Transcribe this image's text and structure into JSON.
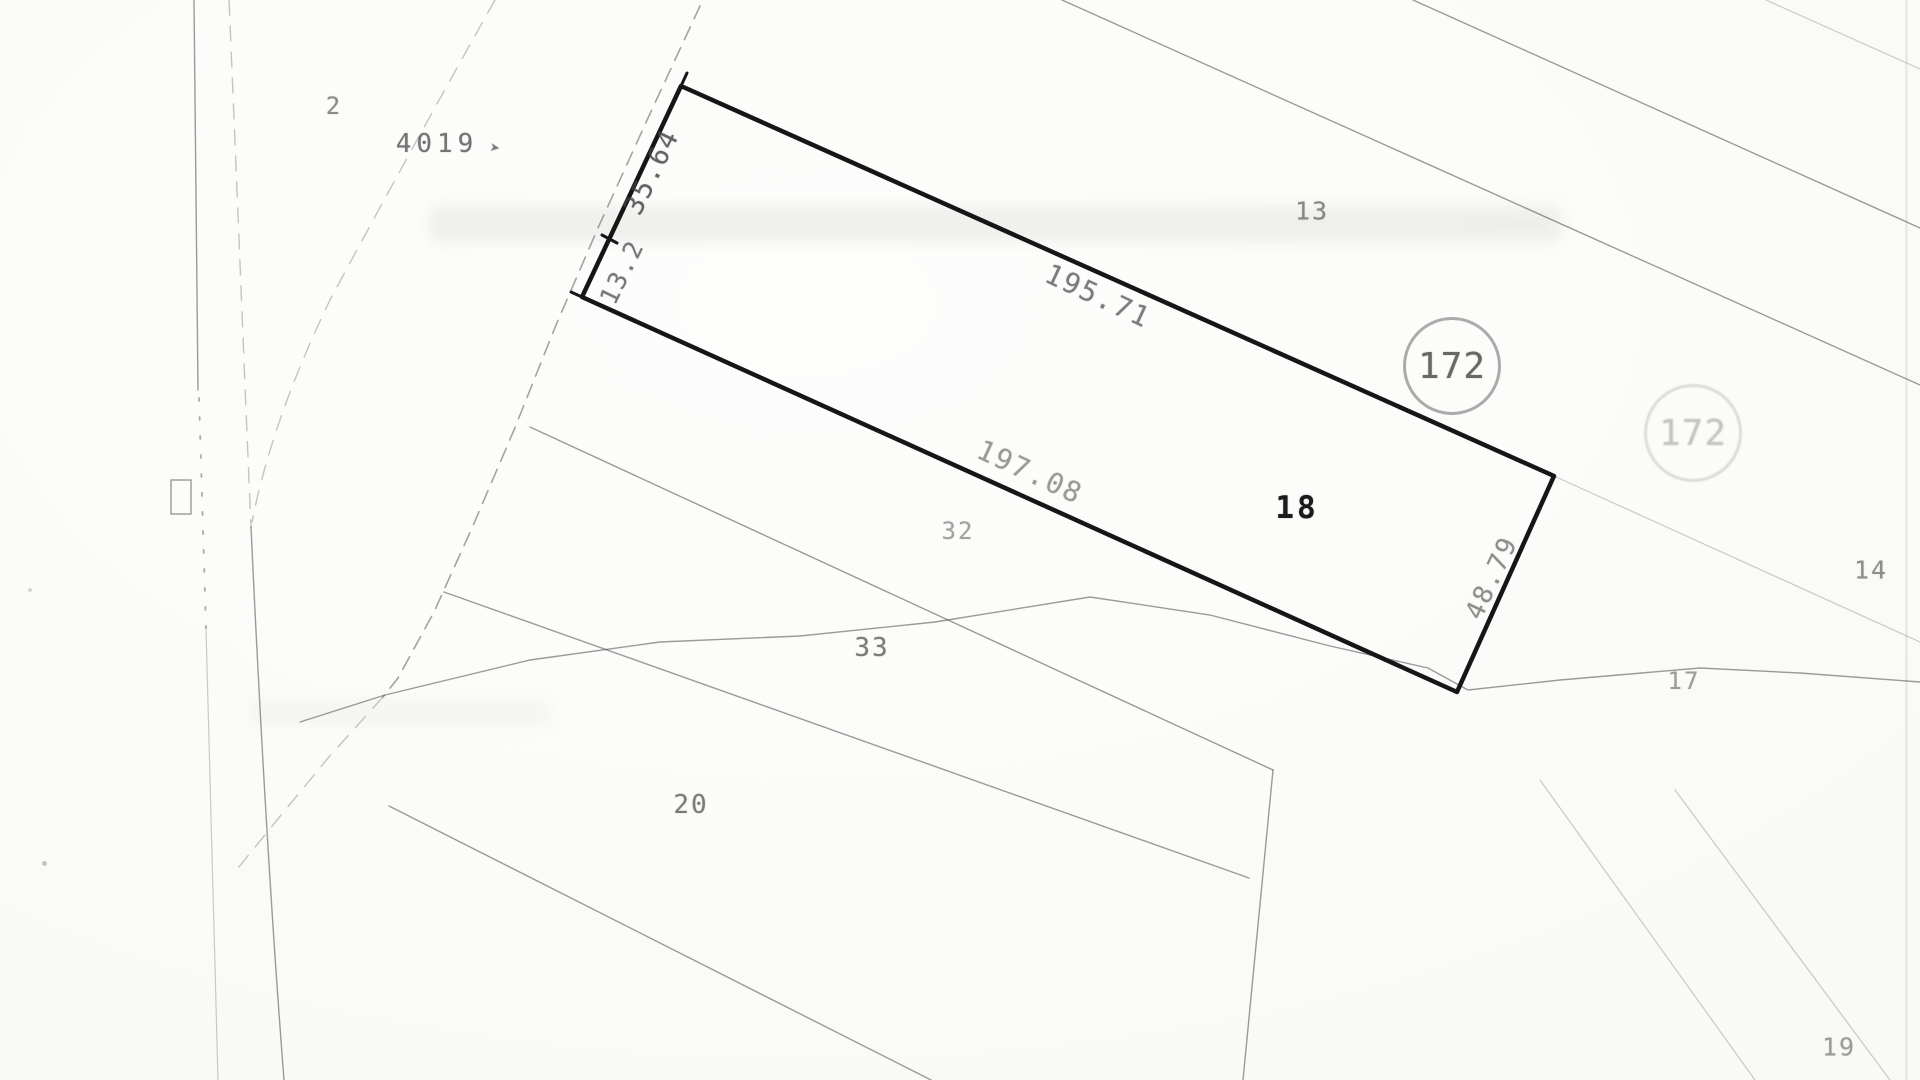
{
  "document": {
    "kind": "scanned cadastral parcel map",
    "target_parcel": {
      "number": "18",
      "reference": "172",
      "edge_lengths": {
        "left_upper": "35.64",
        "left_lower": "13.2",
        "top": "195.71",
        "bottom": "197.08",
        "right": "48.79"
      }
    },
    "labels": {
      "parcel_2": "2",
      "road": "4019",
      "parcel_13": "13",
      "ref_172_a": "172",
      "ref_172_b": "172",
      "parcel_18": "18",
      "parcel_32": "32",
      "parcel_33": "33",
      "parcel_20": "20",
      "parcel_14": "14",
      "parcel_17": "17",
      "parcel_19": "19"
    },
    "dimensions": {
      "left_upper": "35.64",
      "left_lower": "13.2",
      "top_edge": "195.71",
      "bottom_edge": "197.08",
      "right_edge": "48.79"
    },
    "icons": {
      "road_arrow": "➤"
    },
    "colors": {
      "paper": "#fcfcfb",
      "ink": "#3f3f3f",
      "bold_ink": "#161616"
    }
  }
}
